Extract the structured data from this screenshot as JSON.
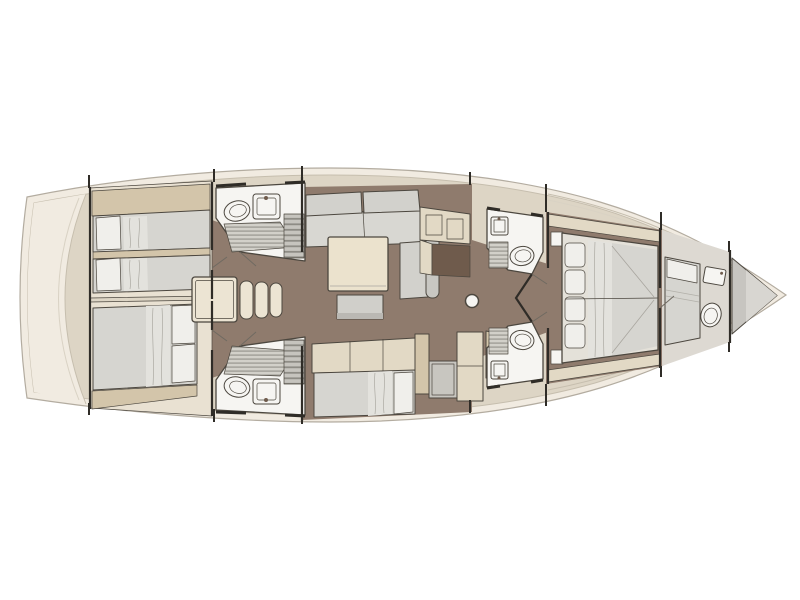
{
  "meta": {
    "description": "Sailing yacht interior deck plan, top-down view, bow pointing right, stern at left",
    "view": "top-down floor plan",
    "orientation": {
      "bow": "right",
      "stern": "left"
    }
  },
  "palette": {
    "page_bg": "#ffffff",
    "hull_rim": "#f1ebe1",
    "hull_stroke": "#b3aca0",
    "deck_band": "#ddd5c5",
    "deck_line": "#c6beae",
    "cabin_bg": "#e9e1d2",
    "wood_floor": "#8f7b6d",
    "furniture_tan": "#d3c5aa",
    "furniture_beige": "#e2d9c5",
    "engine_cream": "#ece4d3",
    "mattress_gray": "#d6d5d0",
    "duvet_light": "#e3e2dd",
    "pillow_white": "#f0efeb",
    "cushion_gray": "#d2d1cc",
    "armrest_gray": "#c8c7c2",
    "table_cream": "#ebe2cd",
    "bench_gray": "#d0cfca",
    "counter_gray": "#c8c6c0",
    "grate_bg": "#d2d0c9",
    "grate_line": "#a19f97",
    "louver_bg": "#c6c4be",
    "louver_line": "#8e8c85",
    "fixture_white": "#f6f5f2",
    "desk_dark": "#6f5b4c",
    "forepeak_gray": "#c7c5c0",
    "forepeak_light": "#d8d6d1",
    "outline": "#4c473f",
    "wall": "#2f2c27"
  },
  "areas": [
    {
      "name": "aft-cabin-port",
      "items": [
        "twin-bed",
        "twin-bed",
        "outboard-shelf",
        "mid-shelf"
      ]
    },
    {
      "name": "aft-head-port",
      "items": [
        "toilet",
        "sink",
        "shower-grate",
        "louver-locker"
      ]
    },
    {
      "name": "companionway",
      "items": [
        "engine-box",
        "step",
        "step",
        "step"
      ]
    },
    {
      "name": "aft-head-starboard",
      "items": [
        "shower-grate",
        "toilet",
        "sink",
        "louver-locker"
      ]
    },
    {
      "name": "aft-cabin-starboard",
      "items": [
        "double-bed",
        "pillow",
        "pillow",
        "foot-shelf"
      ]
    },
    {
      "name": "salon",
      "items": [
        "l-sofa",
        "corner-chaise",
        "armrest",
        "coffee-table",
        "bench",
        "sideboard",
        "nav-desk"
      ]
    },
    {
      "name": "galley",
      "items": [
        "settee-berth",
        "pillow",
        "low-cabinet",
        "sink-counter",
        "tall-locker",
        "louver-counter",
        "small-sink"
      ]
    },
    {
      "name": "fwd-head-port",
      "items": [
        "sink",
        "shower-grate",
        "toilet"
      ]
    },
    {
      "name": "fwd-head-starboard",
      "items": [
        "shower-grate",
        "toilet",
        "sink"
      ]
    },
    {
      "name": "owner-cabin",
      "items": [
        "island-double-bed",
        "pillow",
        "pillow",
        "pillow",
        "pillow",
        "nightstand",
        "nightstand",
        "side-shelf",
        "side-shelf"
      ]
    },
    {
      "name": "crew-cabin",
      "items": [
        "berth",
        "pillow",
        "sink",
        "toilet"
      ]
    },
    {
      "name": "forepeak",
      "items": [
        "anchor-locker"
      ]
    },
    {
      "name": "mast-post",
      "items": []
    }
  ]
}
